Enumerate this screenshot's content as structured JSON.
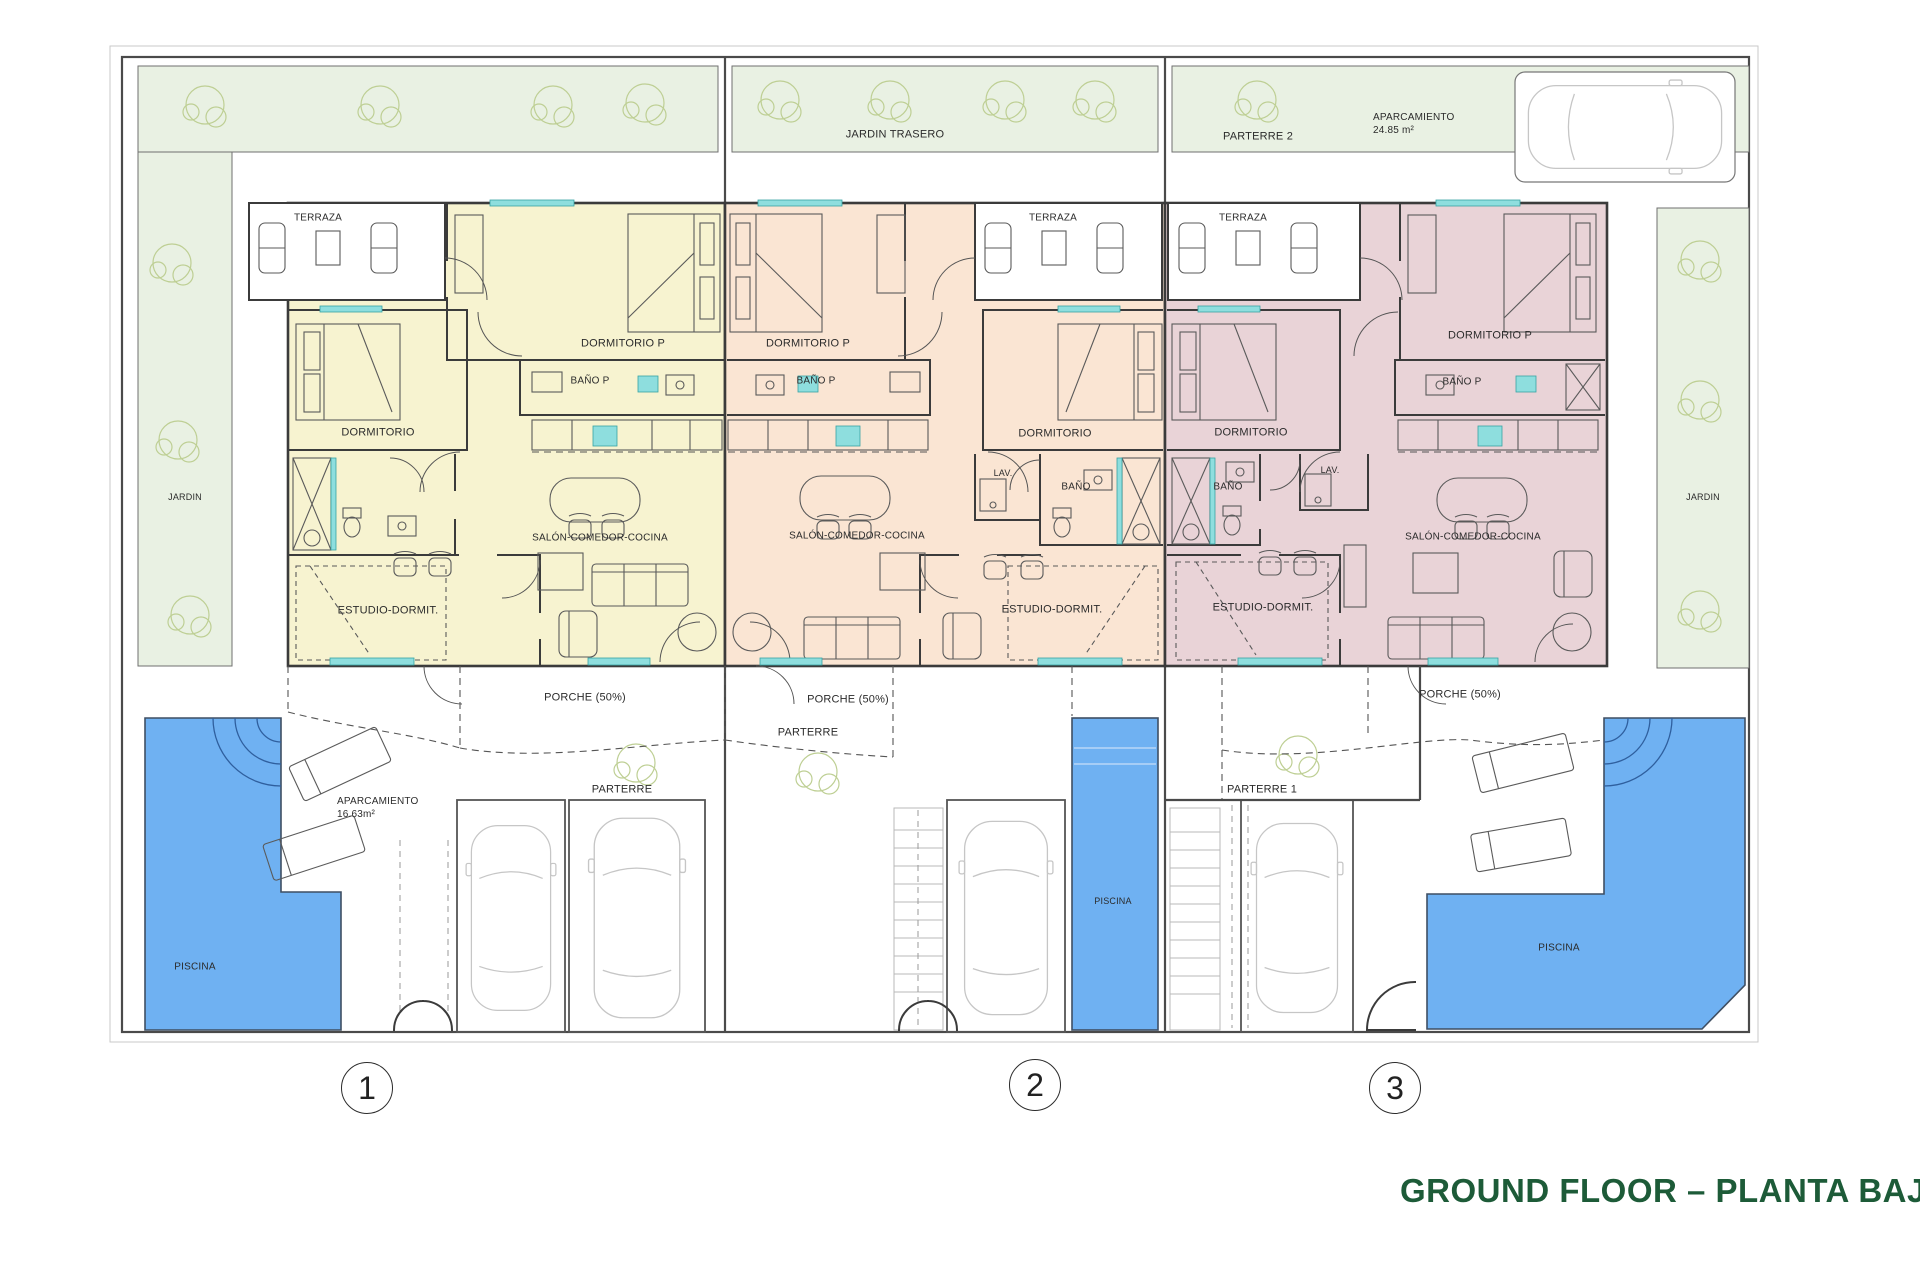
{
  "title": "GROUND FLOOR – PLANTA BAJA",
  "site": {
    "jardin_left": "JARDIN",
    "jardin_right": "JARDIN",
    "parking": {
      "label": "APARCAMIENTO",
      "area": "24.85 m²"
    }
  },
  "units": [
    {
      "number": "1",
      "terraza": "TERRAZA",
      "dormitorio_p": "DORMITORIO P",
      "bano_p": "BAÑO P",
      "dormitorio": "DORMITORIO",
      "salon": "SALÓN-COMEDOR-COCINA",
      "estudio": "ESTUDIO-DORMIT.",
      "porche": "PORCHE (50%)",
      "parterre": "PARTERRE",
      "piscina": "PISCINA",
      "parking": {
        "label": "APARCAMIENTO",
        "area": "16.63m²"
      }
    },
    {
      "number": "2",
      "jardin_trasero": "JARDIN TRASERO",
      "terraza": "TERRAZA",
      "dormitorio_p": "DORMITORIO P",
      "bano_p": "BAÑO P",
      "dormitorio": "DORMITORIO",
      "lav": "LAV.",
      "bano": "BAÑO",
      "salon": "SALÓN-COMEDOR-COCINA",
      "estudio": "ESTUDIO-DORMIT.",
      "porche": "PORCHE (50%)",
      "parterre": "PARTERRE",
      "piscina": "PISCINA"
    },
    {
      "number": "3",
      "parterre_2": "PARTERRE 2",
      "terraza": "TERRAZA",
      "dormitorio_p": "DORMITORIO P",
      "bano_p": "BAÑO P",
      "dormitorio": "DORMITORIO",
      "lav": "LAV.",
      "bano": "BAÑO",
      "salon": "SALÓN-COMEDOR-COCINA",
      "estudio": "ESTUDIO-DORMIT.",
      "porche": "PORCHE (50%)",
      "parterre_1": "PARTERRE 1",
      "piscina": "PISCINA"
    }
  ]
}
